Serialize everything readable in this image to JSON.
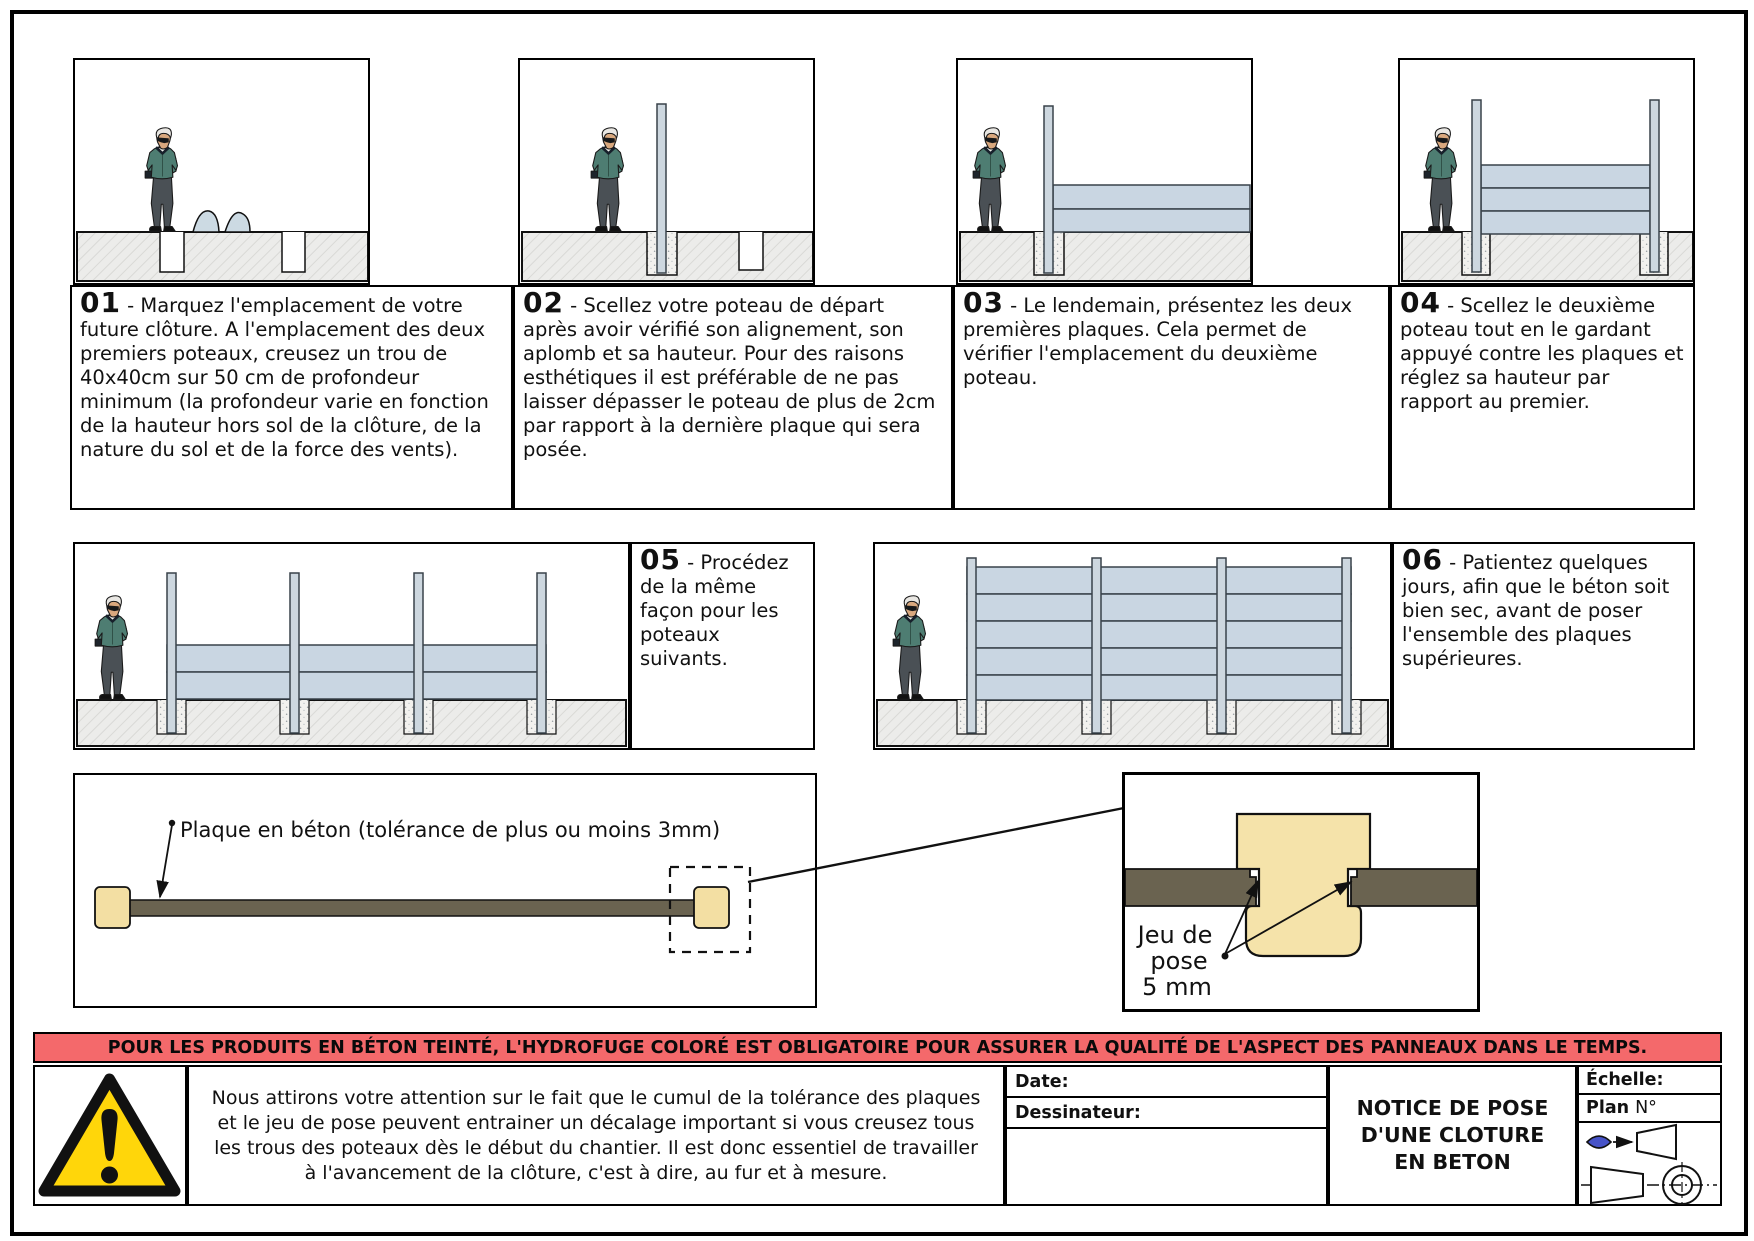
{
  "steps": [
    {
      "number": "01",
      "text": "- Marquez l'emplacement de votre future clôture. A l'emplacement des deux premiers poteaux, creusez un trou de 40x40cm sur 50 cm de profondeur minimum (la profondeur varie en fonction de la hauteur hors sol de la clôture, de la nature du sol et de la force des vents)."
    },
    {
      "number": "02",
      "text": "- Scellez votre poteau de départ après avoir vérifié son alignement, son aplomb et sa hauteur. Pour des raisons esthétiques il est préférable de ne pas laisser dépasser le poteau de plus de 2cm par rapport à la dernière plaque qui sera posée."
    },
    {
      "number": "03",
      "text": "- Le lendemain, présentez les deux premières plaques. Cela permet de vérifier l'emplacement du deuxième poteau."
    },
    {
      "number": "04",
      "text": "- Scellez le deuxième poteau tout en le gardant appuyé contre les plaques et réglez sa hauteur par rapport au premier."
    },
    {
      "number": "05",
      "text": "- Procédez de la même façon pour les poteaux suivants."
    },
    {
      "number": "06",
      "text": "- Patientez quelques jours, afin que le béton soit bien sec, avant de poser l'ensemble des plaques supérieures."
    }
  ],
  "plan_view": {
    "label": "Plaque en béton (tolérance de plus ou moins 3mm)"
  },
  "detail_view": {
    "jeu_line1": "Jeu de",
    "jeu_line2": "pose",
    "jeu_line3": "5 mm"
  },
  "banner": {
    "text": "POUR LES PRODUITS EN BÉTON TEINTÉ, L'HYDROFUGE COLORÉ EST OBLIGATOIRE POUR ASSURER LA QUALITÉ DE L'ASPECT DES PANNEAUX DANS LE TEMPS."
  },
  "footer": {
    "warning_text": "Nous attirons votre attention sur le fait que le cumul de la tolérance des plaques et le jeu de pose peuvent entrainer un décalage important si vous creusez tous les trous des poteaux dès le début du chantier. Il est donc essentiel de travailler à l'avancement de la clôture, c'est à dire, au fur et à mesure.",
    "date_label": "Date:",
    "drafter_label": "Dessinateur:",
    "title": "NOTICE DE POSE\nD'UNE CLOTURE\nEN BETON",
    "scale_label": "Échelle:",
    "plan_label": "Plan",
    "plan_no": "N°"
  },
  "colors": {
    "banner_bg": "#f4696b",
    "plate_dark": "#6a6350",
    "post_tan": "#f3dfa3",
    "plate_blue": "#c9d6e2",
    "post_blue": "#cdd7df",
    "warning_yellow": "#ffd60a",
    "eye_blue": "#4753c8"
  }
}
